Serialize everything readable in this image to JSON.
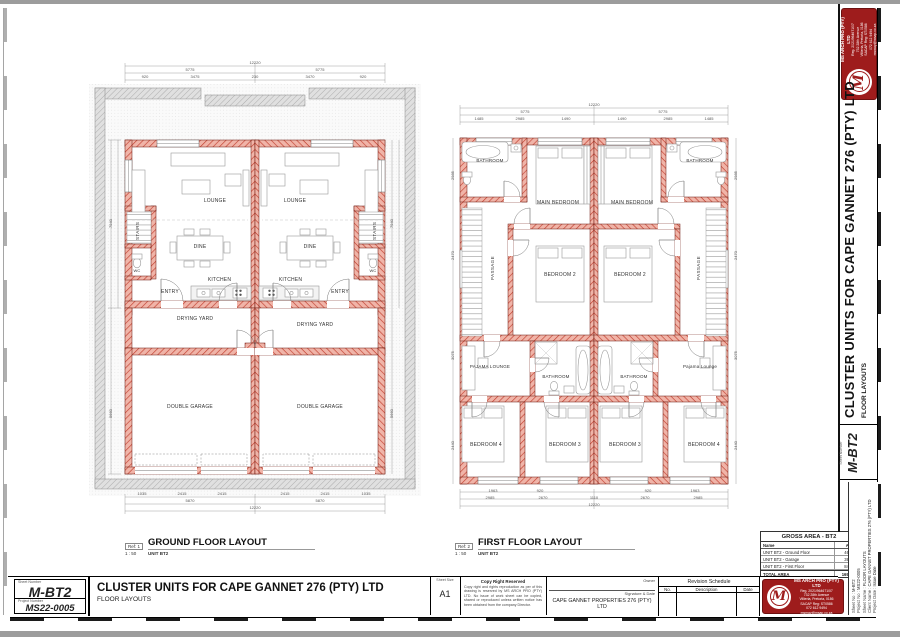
{
  "sheet": {
    "project_title": "CLUSTER UNITS FOR CAPE GANNET 276 (PTY) LTD",
    "sheet_name": "FLOOR LAYOUTS",
    "sheet_number_label": "Sheet Number",
    "sheet_number": "M-BT2",
    "project_number_label": "Project Number",
    "project_number": "MS22-0005",
    "sheet_size_label": "Sheet Size",
    "sheet_size": "A1",
    "copyright_title": "Copy Right Reserved",
    "copyright_text": "Copy right and rights reproduction as per of this drawing is reserved by MS ARCH PRO (PTY) LTD. No issue of work sheet can be copied, shared or reproduced unless written notice has been obtained from the company Director.",
    "owner_label": "Owner",
    "signature_label": "Signature & Date",
    "client_name": "CAPE GANNET PROPERTIES 276 (PTY) LTD"
  },
  "fields": [
    {
      "label": "Sheet No :",
      "value": "M-BT2"
    },
    {
      "label": "Project No :",
      "value": "MS22-0005"
    },
    {
      "label": "Sheet Name :",
      "value": "FLOOR LAYOUTS"
    },
    {
      "label": "Client Name :",
      "value": "CAPE GANNET PROPERTIES 276 (PTY) LTD"
    },
    {
      "label": "Project Date :",
      "value": "Issue Date"
    }
  ],
  "revision_schedule": {
    "title": "Revision Schedule",
    "col_no": "No.",
    "col_description": "Description",
    "col_date": "Date"
  },
  "logo": {
    "monogram": "M",
    "company": "MS ARCH PRO (PTY) LTD",
    "line1": "Reg. 2021/964671/07",
    "line2": "732 28th Avenue",
    "line3": "Villieria, Pretoria, 0186",
    "line4": "SACAP Reg: ST0586",
    "line5": "072 612 9494",
    "line6": "msmay@msap.co.za"
  },
  "gross_area": {
    "title": "GROSS AREA - BT2",
    "col_name": "Name",
    "col_area": "Area",
    "rows": [
      {
        "name": "UNIT BT2 - Ground Floor",
        "area": "46 m²"
      },
      {
        "name": "UNIT BT2 - Garage",
        "area": "39 m²"
      },
      {
        "name": "UNIT BT2 - First Floor",
        "area": "84 m²"
      },
      {
        "name": "TOTAL AREA",
        "area": "169 m²"
      }
    ]
  },
  "ground_floor": {
    "ref": "Ref: 1",
    "title": "GROUND FLOOR LAYOUT",
    "scale": "1 : 50",
    "unit": "UNIT BT2",
    "rooms": {
      "lounge": "LOUNGE",
      "dine": "DINE",
      "kitchen": "KITCHEN",
      "entry": "ENTRY",
      "wc": "WC",
      "stairs": "STAIRS",
      "drying_yard": "DRYING YARD",
      "double_garage": "DOUBLE GARAGE"
    },
    "dims": {
      "overall_top": "12220",
      "halves_top": [
        "5775",
        "5775"
      ],
      "top": [
        "920",
        "3475",
        "230",
        "3470",
        "920"
      ],
      "bottom_a": [
        "1035",
        "2415",
        "2415",
        "2415",
        "2415",
        "1035"
      ],
      "bottom_b": [
        "5870",
        "5870"
      ],
      "overall_bottom": "12220",
      "left": [
        "7940",
        "5660"
      ],
      "right": [
        "7940",
        "5660"
      ]
    }
  },
  "first_floor": {
    "ref": "Ref: 2",
    "title": "FIRST FLOOR LAYOUT",
    "scale": "1 : 50",
    "unit": "UNIT BT2",
    "rooms": {
      "bathroom": "BATHROOM",
      "main_bedroom": "MAIN BEDROOM",
      "bedroom2": "BEDROOM 2",
      "bedroom3": "BEDROOM 3",
      "bedroom4": "BEDROOM 4",
      "passage": "PASSAGE",
      "pajama_lounge": "PAJAMA LOUNGE",
      "pajama_lounge_right": "Pajama Lounge"
    },
    "dims": {
      "overall_top": "12220",
      "halves_top": [
        "5775",
        "5775"
      ],
      "top": [
        "1485",
        "2985",
        "1490",
        "1490",
        "2985",
        "1485"
      ],
      "bottom_a": [
        "1963",
        "920",
        "920",
        "1963"
      ],
      "bottom_b": [
        "2985",
        "2670",
        "1110",
        "2670",
        "2985"
      ],
      "overall_bottom": "12220",
      "left": [
        "2985",
        "2470",
        "3075",
        "2440"
      ],
      "right": [
        "2985",
        "2470",
        "3075",
        "2440"
      ]
    }
  },
  "colors": {
    "wall_red": "#c14030",
    "wall_fill": "#f0b4a8",
    "grey_hatch": "#bdbdbd",
    "logo_red": "#9e1c1c",
    "line": "#333333"
  }
}
